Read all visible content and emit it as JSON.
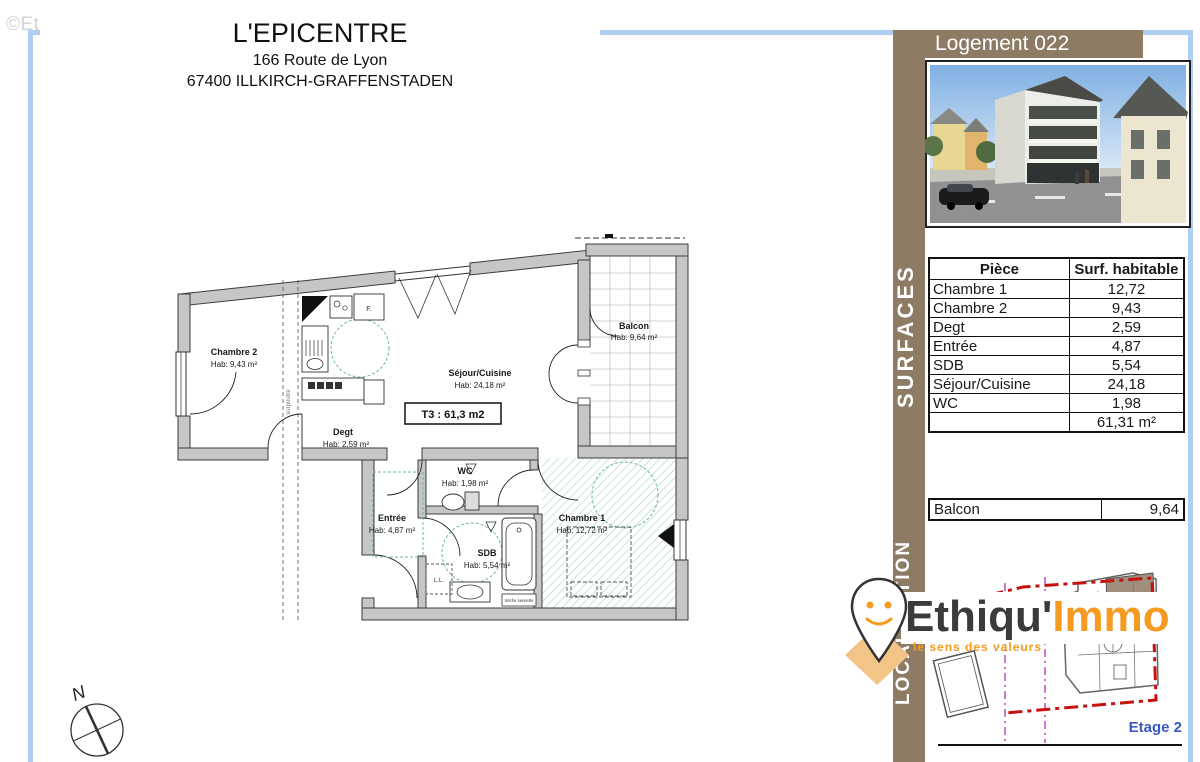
{
  "watermark": "©EtreProprio.com",
  "title_block": {
    "name": "L'EPICENTRE",
    "address1": "166 Route de Lyon",
    "address2": "67400 ILLKIRCH-GRAFFENSTADEN"
  },
  "side_panel": {
    "logement": "Logement 022",
    "surfaces_label": "SURFACES",
    "localisation_label": "LOCALISATION",
    "surface_table": {
      "col_piece": "Pièce",
      "col_surface": "Surf. habitable",
      "rows": [
        [
          "Chambre 1",
          "12,72"
        ],
        [
          "Chambre 2",
          "9,43"
        ],
        [
          "Degt",
          "2,59"
        ],
        [
          "Entrée",
          "4,87"
        ],
        [
          "SDB",
          "5,54"
        ],
        [
          "Séjour/Cuisine",
          "24,18"
        ],
        [
          "WC",
          "1,98"
        ]
      ],
      "total": "61,31 m²"
    },
    "balcon_row": {
      "label": "Balcon",
      "value": "9,64"
    },
    "brand": {
      "name_dark": "Ethiqu'",
      "name_orange": "Immo",
      "tagline": "le sens des valeurs"
    },
    "etage": "Etage 2"
  },
  "floorplan": {
    "t3": "T3 : 61,3 m2",
    "rooms": {
      "chambre2": {
        "name": "Chambre 2",
        "area": "Hab: 9,43 m²"
      },
      "sejour": {
        "name": "Séjour/Cuisine",
        "area": "Hab: 24,18 m²"
      },
      "balcon": {
        "name": "Balcon",
        "area": "Hab: 9,64 m²"
      },
      "degt": {
        "name": "Degt",
        "area": "Hab: 2,59 m²"
      },
      "wc": {
        "name": "WC",
        "area": "Hab: 1,98 m²"
      },
      "entree": {
        "name": "Entrée",
        "area": "Hab: 4,87 m²"
      },
      "sdb": {
        "name": "SDB",
        "area": "Hab: 5,54 m²"
      },
      "chambre1": {
        "name": "Chambre 1",
        "area": "Hab: 12,72 m²"
      }
    },
    "annotations": {
      "surpoutre": "surpoutre",
      "lavelinge": "L.L.",
      "frigo": "F.",
      "seche_serviette": "Sèche serviette",
      "north": "N"
    }
  },
  "colors": {
    "panel_brown": "#8d7b63",
    "frame_blue": "#aecff2",
    "brand_orange": "#f59b22",
    "brand_dark": "#3b3b3b",
    "etage_blue": "#3a57c4",
    "boundary_red": "#c51210",
    "hatch_teal": "#8fc4bd",
    "dash_teal": "#6fb3b3"
  }
}
